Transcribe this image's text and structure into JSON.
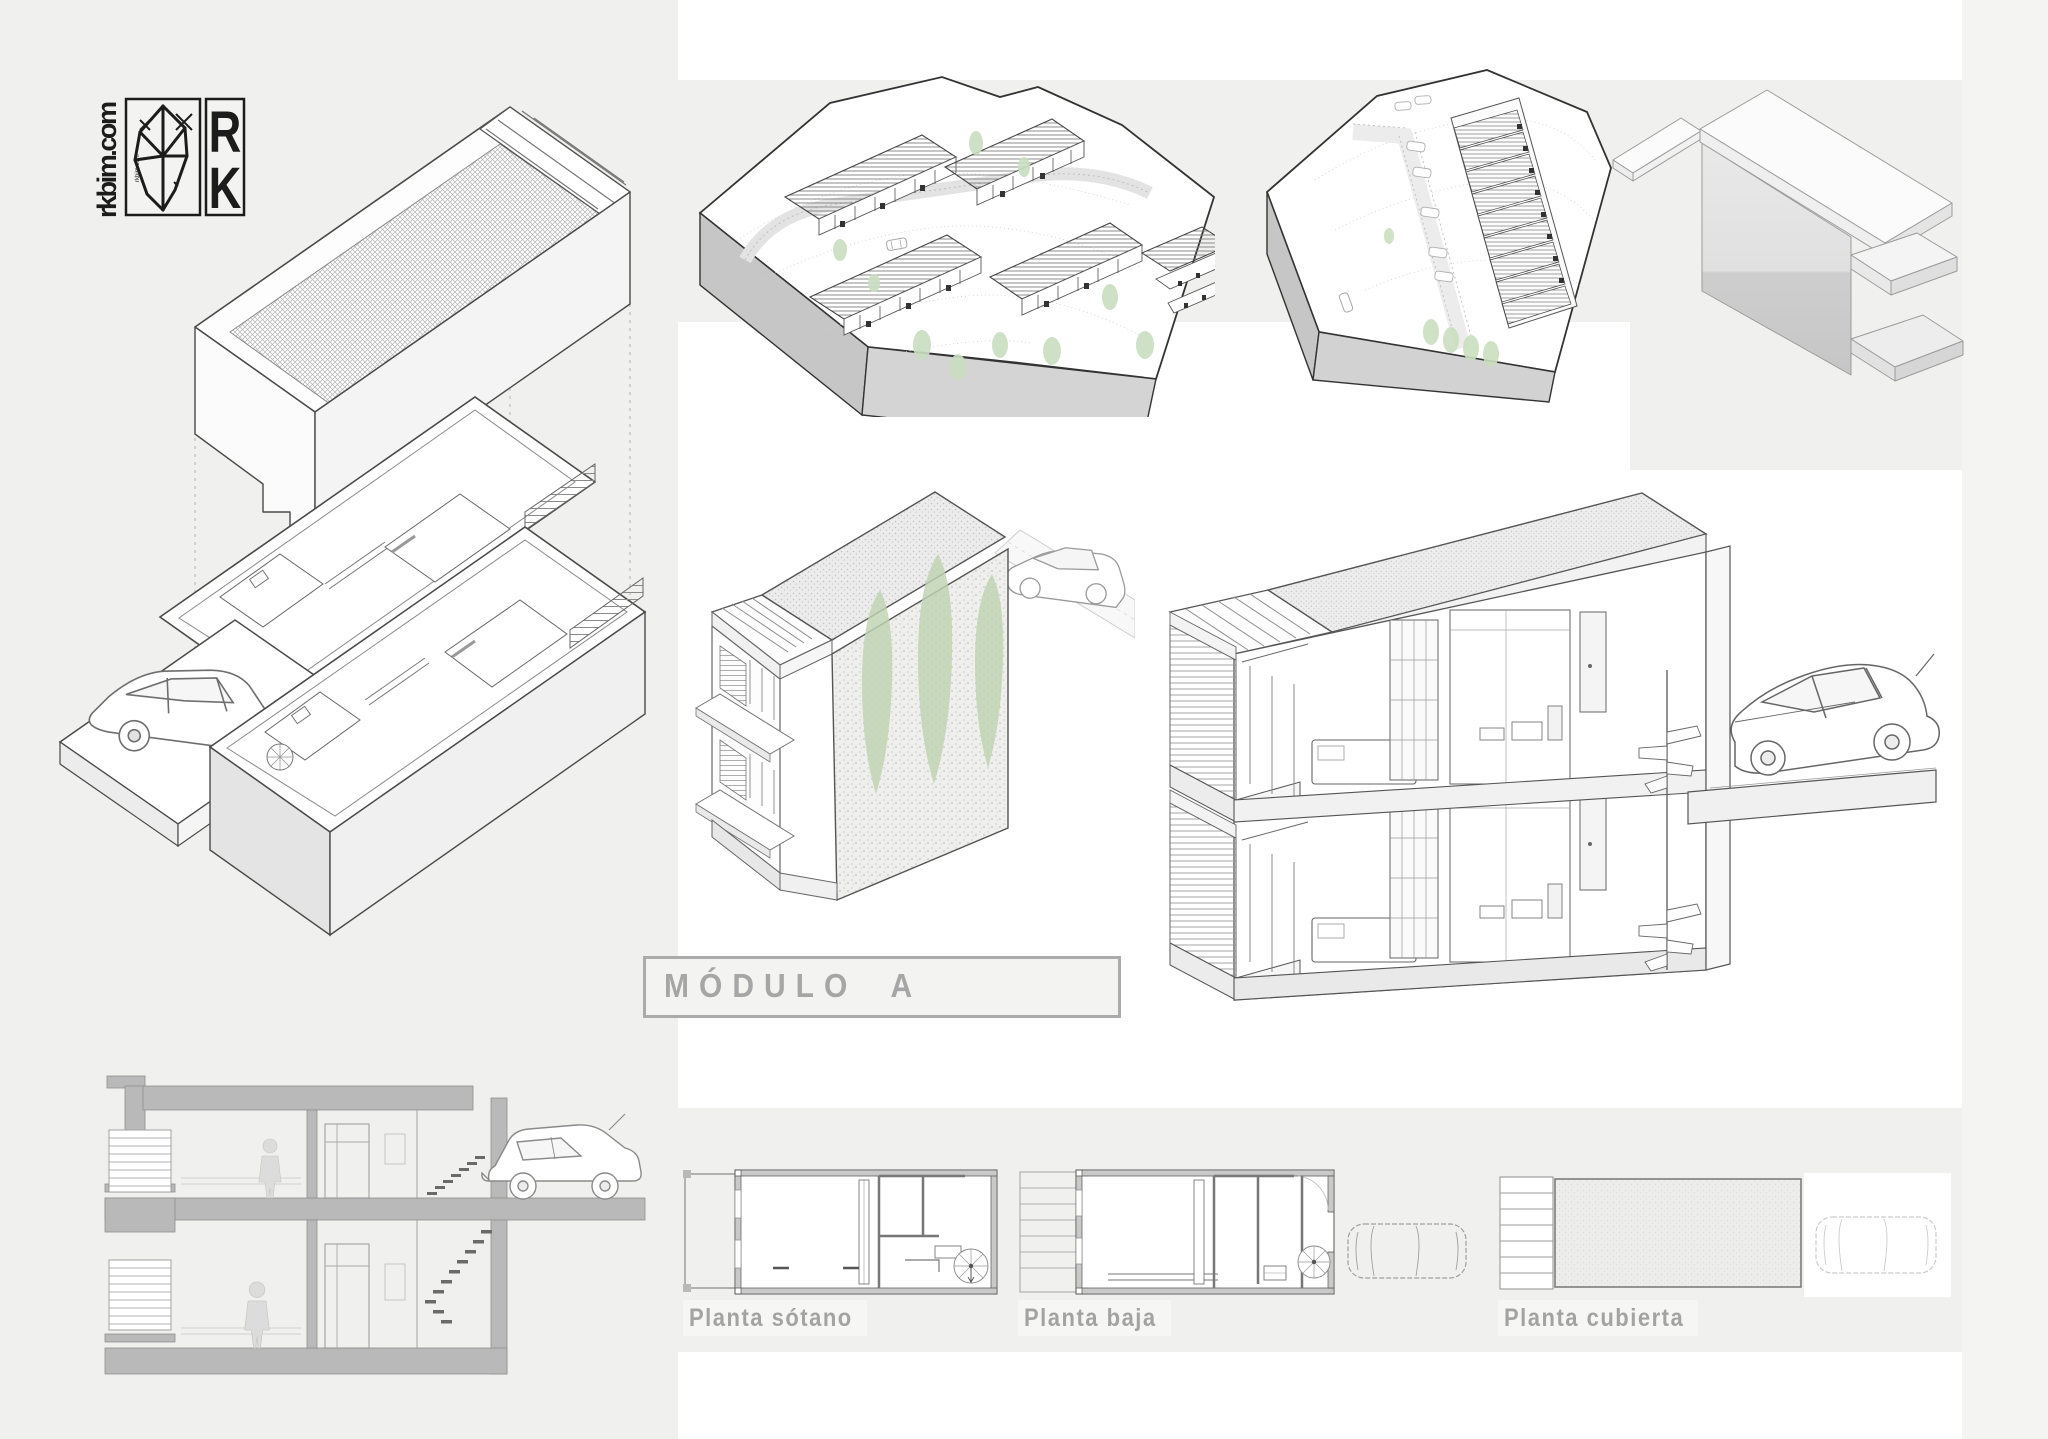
{
  "board": {
    "type": "architecture-presentation-board",
    "logo": {
      "url_text": "rkbim.com",
      "mark_top": "R",
      "mark_bottom": "K"
    },
    "title_box": {
      "label": "MÓDULO A"
    },
    "plan_labels": [
      {
        "id": "planta-sotano",
        "label": "Planta sótano"
      },
      {
        "id": "planta-baja",
        "label": "Planta baja"
      },
      {
        "id": "planta-cubierta",
        "label": "Planta cubierta"
      }
    ],
    "colors": {
      "page_bg": "#ffffff",
      "panel_bg": "#f0f1ef",
      "panel_bg_right": "#f4f5f3",
      "title_text": "#a6a6a6",
      "title_border": "#ababab",
      "label_text": "#a3a3a3",
      "line_dark": "#3f3f3f",
      "line_mid": "#8a8a8a",
      "poche_gray": "#b9b9b9",
      "terrain_side_gray": "#c9c9c9",
      "tree_green": "#c3d8b8",
      "logo_ink": "#1c1c1c"
    }
  }
}
